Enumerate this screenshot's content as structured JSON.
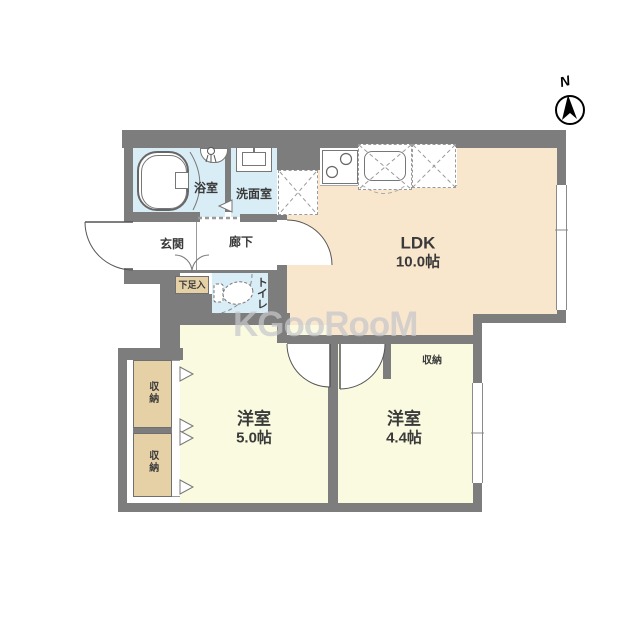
{
  "watermark": "KGooRooM",
  "compass": {
    "label": "N"
  },
  "rooms": {
    "ldk": {
      "name": "LDK",
      "area": "10.0帖"
    },
    "bedroom1": {
      "name": "洋室",
      "area": "5.0帖"
    },
    "bedroom2": {
      "name": "洋室",
      "area": "4.4帖"
    },
    "bathroom": {
      "name": "浴室"
    },
    "washroom": {
      "name": "洗面室"
    },
    "entrance": {
      "name": "玄関"
    },
    "hallway": {
      "name": "廊下"
    },
    "toilet": {
      "name": "トイレ"
    },
    "shoe_cabinet": {
      "name": "下足入"
    },
    "closet_west_upper": {
      "name": "収納"
    },
    "closet_west_lower": {
      "name": "収納"
    },
    "closet_bedroom2": {
      "name": "収納"
    }
  },
  "colors": {
    "wall": "#7d7d7d",
    "ldk_floor": "#f9e7cd",
    "bedroom_floor": "#fafae0",
    "wet_area_floor": "#d9edf6",
    "closet_fill": "#e6d0a6",
    "watermark_gray": "#c6c6cb"
  }
}
